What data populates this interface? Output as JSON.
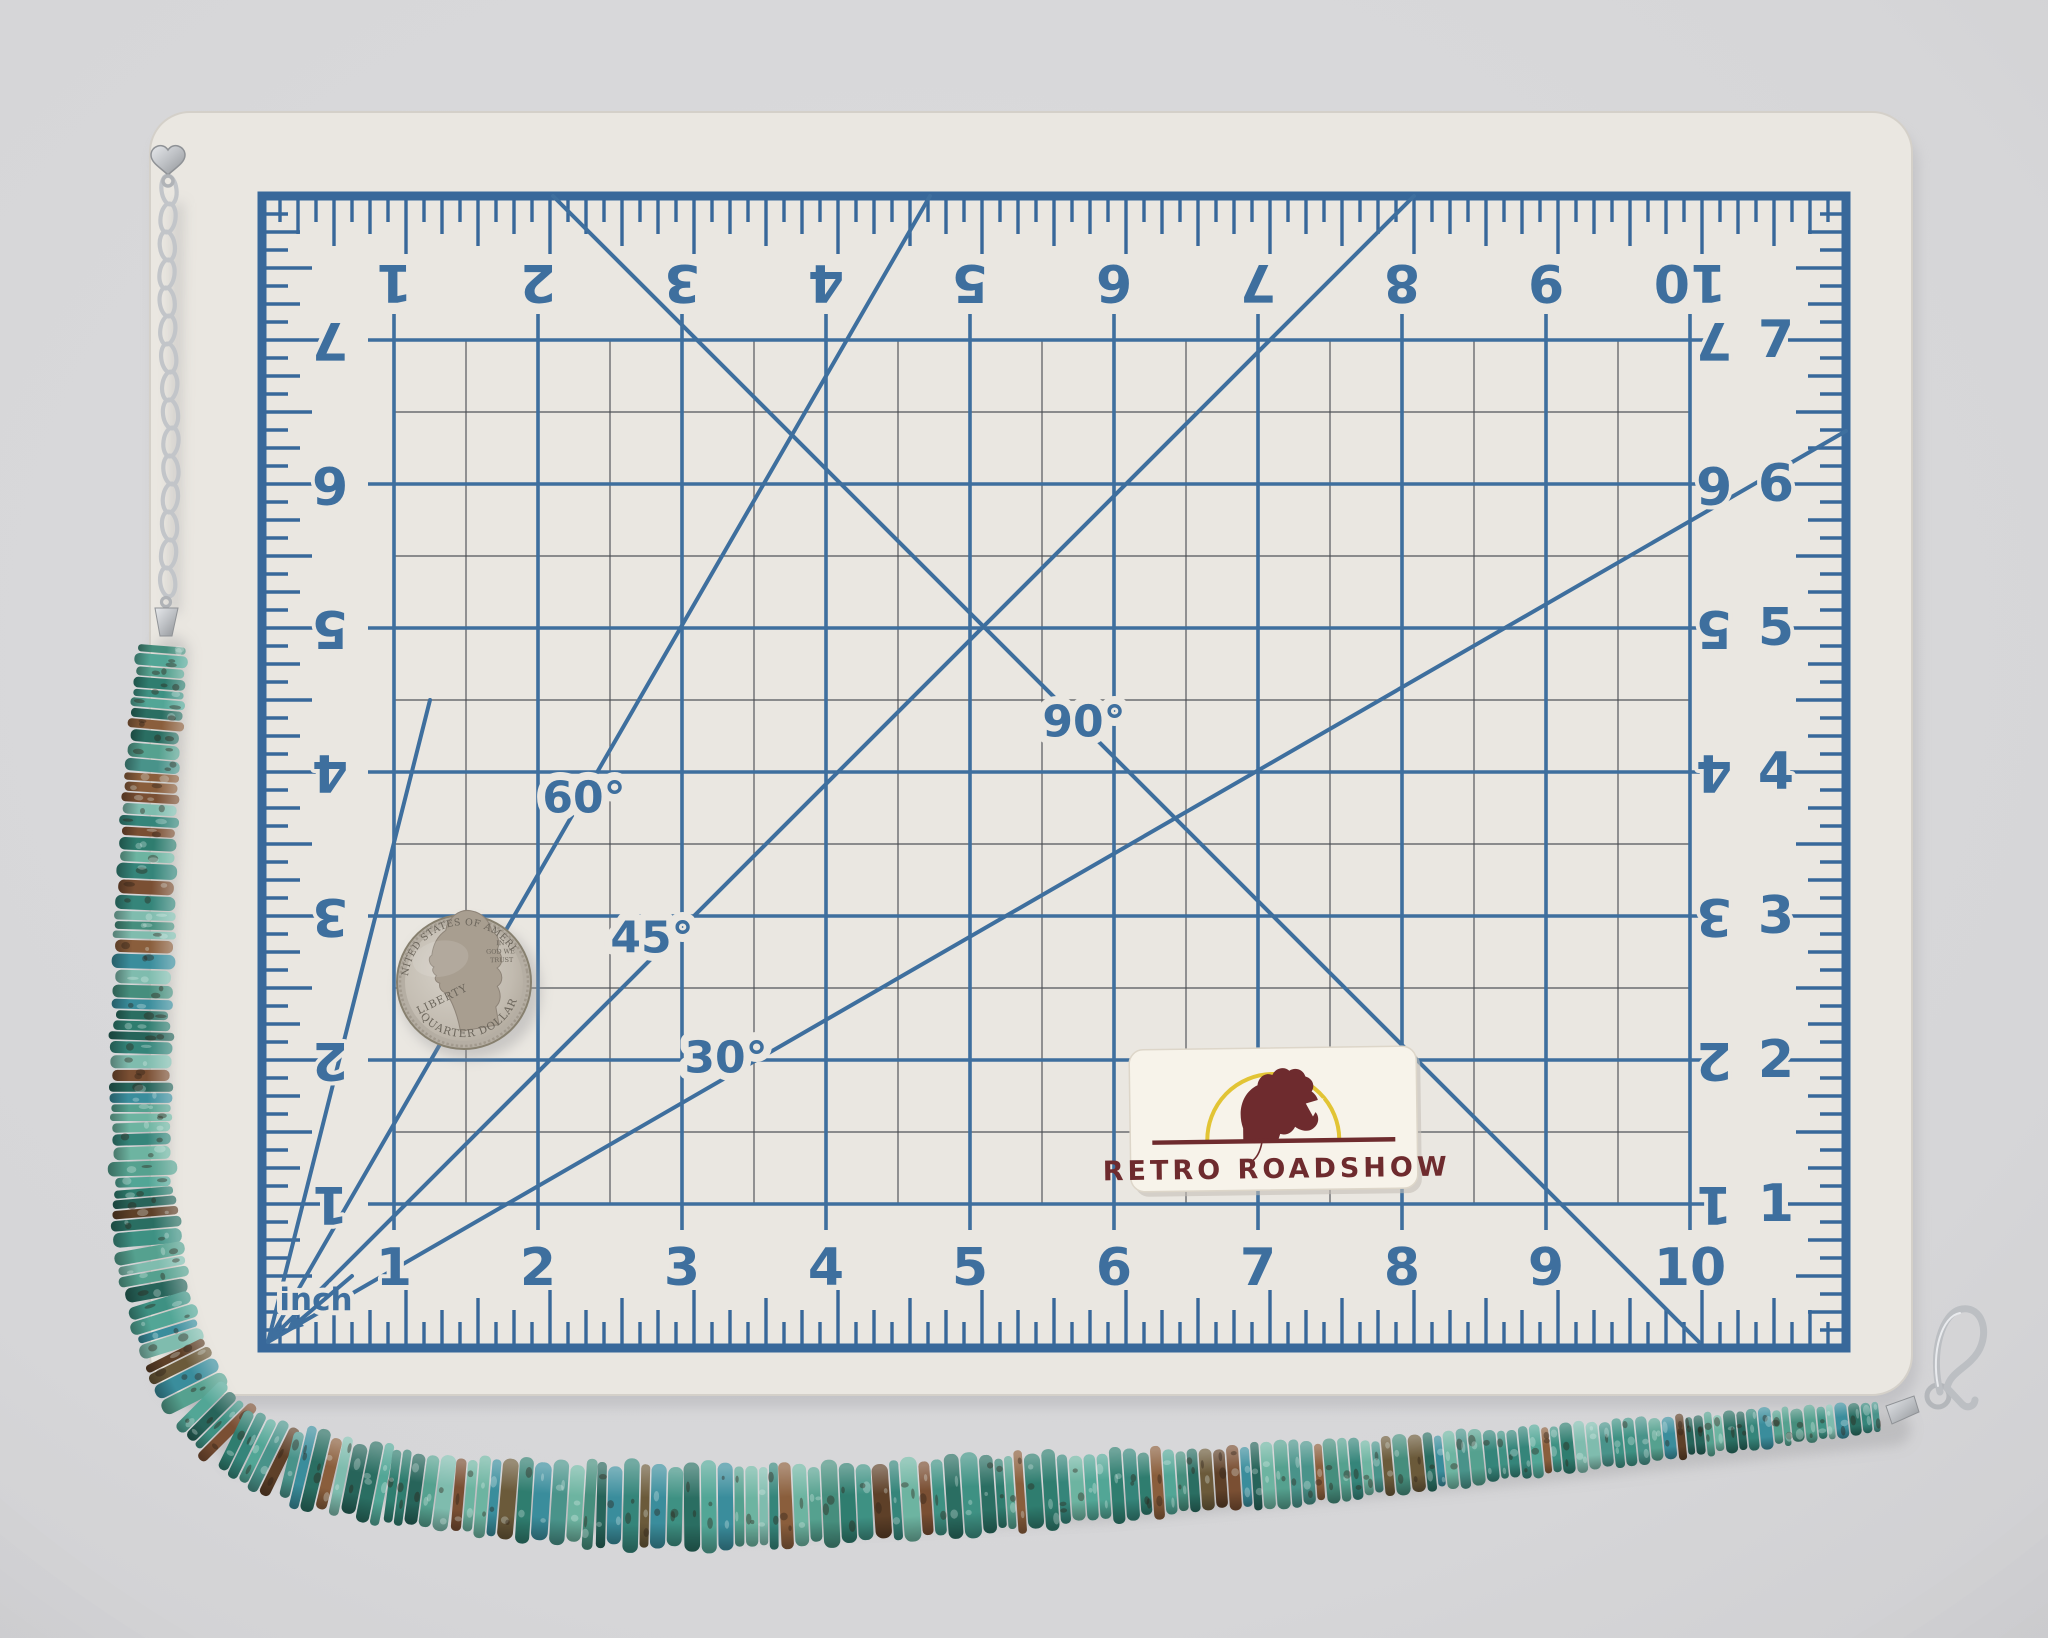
{
  "photo": {
    "background_color": "#d6d6d8",
    "vignette_color": "#bfbfc4"
  },
  "mat": {
    "surface_color": "#eae7e1",
    "grid_color": "#3e6f9e",
    "frame_color": "#38689a",
    "minor_line_color": "#4b4e53",
    "top_numbers": [
      "1",
      "2",
      "3",
      "4",
      "5",
      "6",
      "7",
      "8",
      "9",
      "10"
    ],
    "bottom_numbers": [
      "1",
      "2",
      "3",
      "4",
      "5",
      "6",
      "7",
      "8",
      "9",
      "10"
    ],
    "left_numbers": [
      "7",
      "6",
      "5",
      "4",
      "3",
      "2",
      "1"
    ],
    "right_numbers_inner": [
      "7",
      "6",
      "5",
      "4",
      "3",
      "2",
      "1"
    ],
    "right_numbers_outer": [
      "7",
      "6",
      "5",
      "4",
      "3",
      "2",
      "1"
    ],
    "angle_labels": {
      "a30": "30°",
      "a45": "45°",
      "a60": "60°",
      "a90": "90°"
    },
    "corner_label": "inch"
  },
  "coin": {
    "top_text": "UNITED STATES OF AMERICA",
    "bottom_text": "QUARTER DOLLAR",
    "left_text": "LIBERTY",
    "right_text_lines": [
      "IN",
      "GOD WE",
      "TRUST"
    ],
    "silver_light": "#d6d1c8",
    "silver_mid": "#bdb6ab",
    "silver_dark": "#968e82",
    "relief_color": "#a89e90",
    "text_color": "#6b655b"
  },
  "sticker": {
    "brand_text": "RETRO ROADSHOW",
    "background_color": "#f7f3ea",
    "text_color": "#6e2b2e",
    "arc_color": "#e2c435",
    "logo_color": "#6e2b2e",
    "logo_name": "rooster-head"
  },
  "necklace": {
    "seed": 12,
    "bead_palette": [
      "#3e9183",
      "#2f7d6f",
      "#55a18f",
      "#6db4a1",
      "#2a6e62",
      "#49938a",
      "#7fbcae",
      "#35857a",
      "#27645a",
      "#52a696",
      "#3a8d9c",
      "#468e7d"
    ],
    "matrix_palette": [
      "#7a4f33",
      "#8a5e3c",
      "#5e4028",
      "#6b5a3a"
    ],
    "metal_color": "#c2c5c9",
    "metal_dark": "#8f9296"
  }
}
